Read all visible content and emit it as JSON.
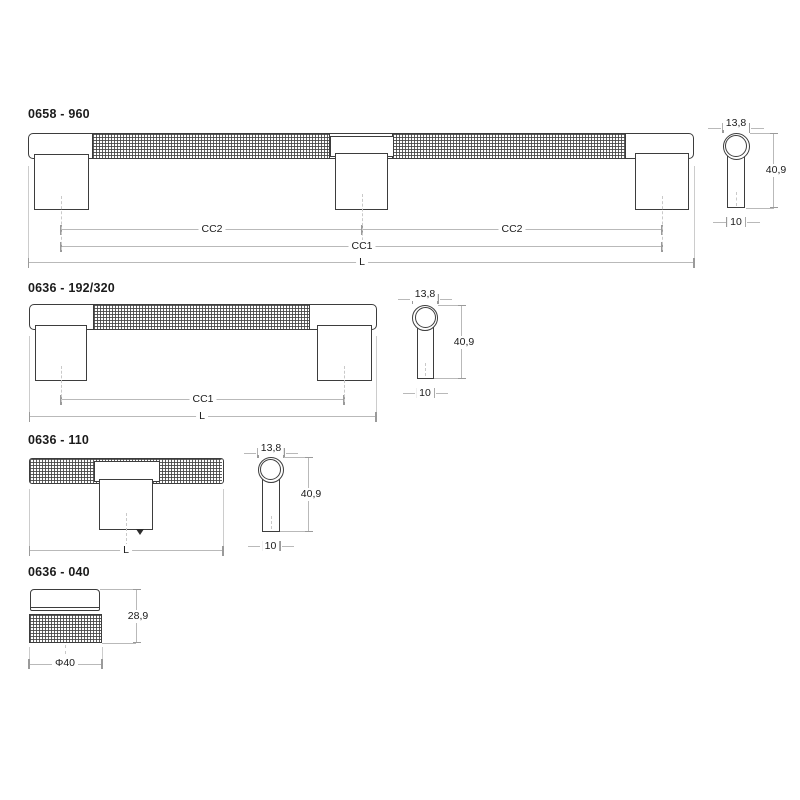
{
  "sheet": {
    "background": "#ffffff",
    "object_line_color": "#3d3d3d",
    "dimension_line_color": "#b9b9b9",
    "text_color": "#1b1b1b"
  },
  "drawings": [
    {
      "title": "0658 - 960",
      "dimensions": {
        "cc2_left": "CC2",
        "cc2_right": "CC2",
        "cc1": "CC1",
        "length": "L"
      },
      "side_view": {
        "diameter": "13,8",
        "height": "40,9",
        "stem_width": "10"
      }
    },
    {
      "title": "0636 - 192/320",
      "dimensions": {
        "cc1": "CC1",
        "length": "L"
      },
      "side_view": {
        "diameter": "13,8",
        "height": "40,9",
        "stem_width": "10"
      }
    },
    {
      "title": "0636 - 110",
      "dimensions": {
        "length": "L"
      },
      "side_view": {
        "diameter": "13,8",
        "height": "40,9",
        "stem_width": "10"
      }
    },
    {
      "title": "0636 - 040",
      "dimensions": {
        "height": "28,9",
        "diameter": "Φ40"
      }
    }
  ]
}
